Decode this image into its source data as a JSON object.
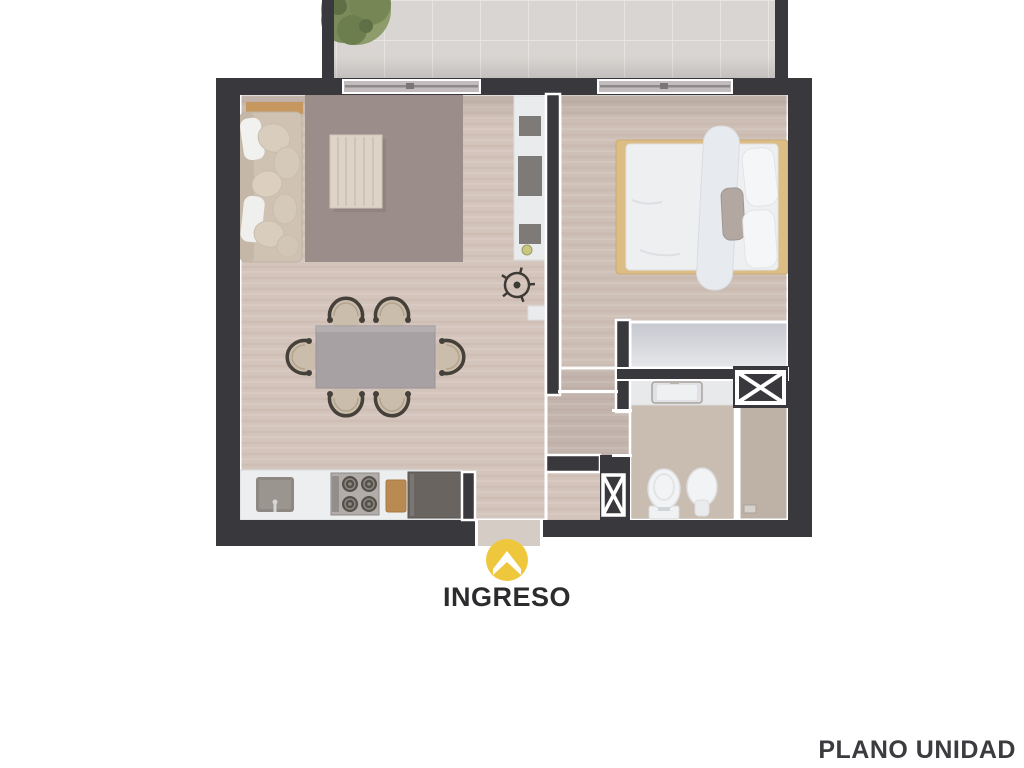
{
  "labels": {
    "entrance": "INGRESO",
    "plan_title": "PLANO UNIDAD"
  },
  "icons": {
    "entrance": "chevron-up-entry-icon",
    "duct": "crossed-box-duct-icon",
    "plant": "plant-icon"
  },
  "colors": {
    "background": "#ffffff",
    "wall": "#38383d",
    "wall_outline": "#ffffff",
    "living_floor": "#d4c5bc",
    "bedroom_floor": "#cfc0b7",
    "corridor_floor": "#c3b5ae",
    "bathroom_floor": "#c9bcb1",
    "shower_floor": "#beb1a6",
    "balcony_tile": "#d8d5d2",
    "rug": "#9b8d8a",
    "closet": "#dcdde2",
    "entrance_accent": "#efc73d",
    "entrance_label_text": "#2c2c2e",
    "plan_title_text": "#3b3b40",
    "plant_green": "#7d8f5a"
  }
}
